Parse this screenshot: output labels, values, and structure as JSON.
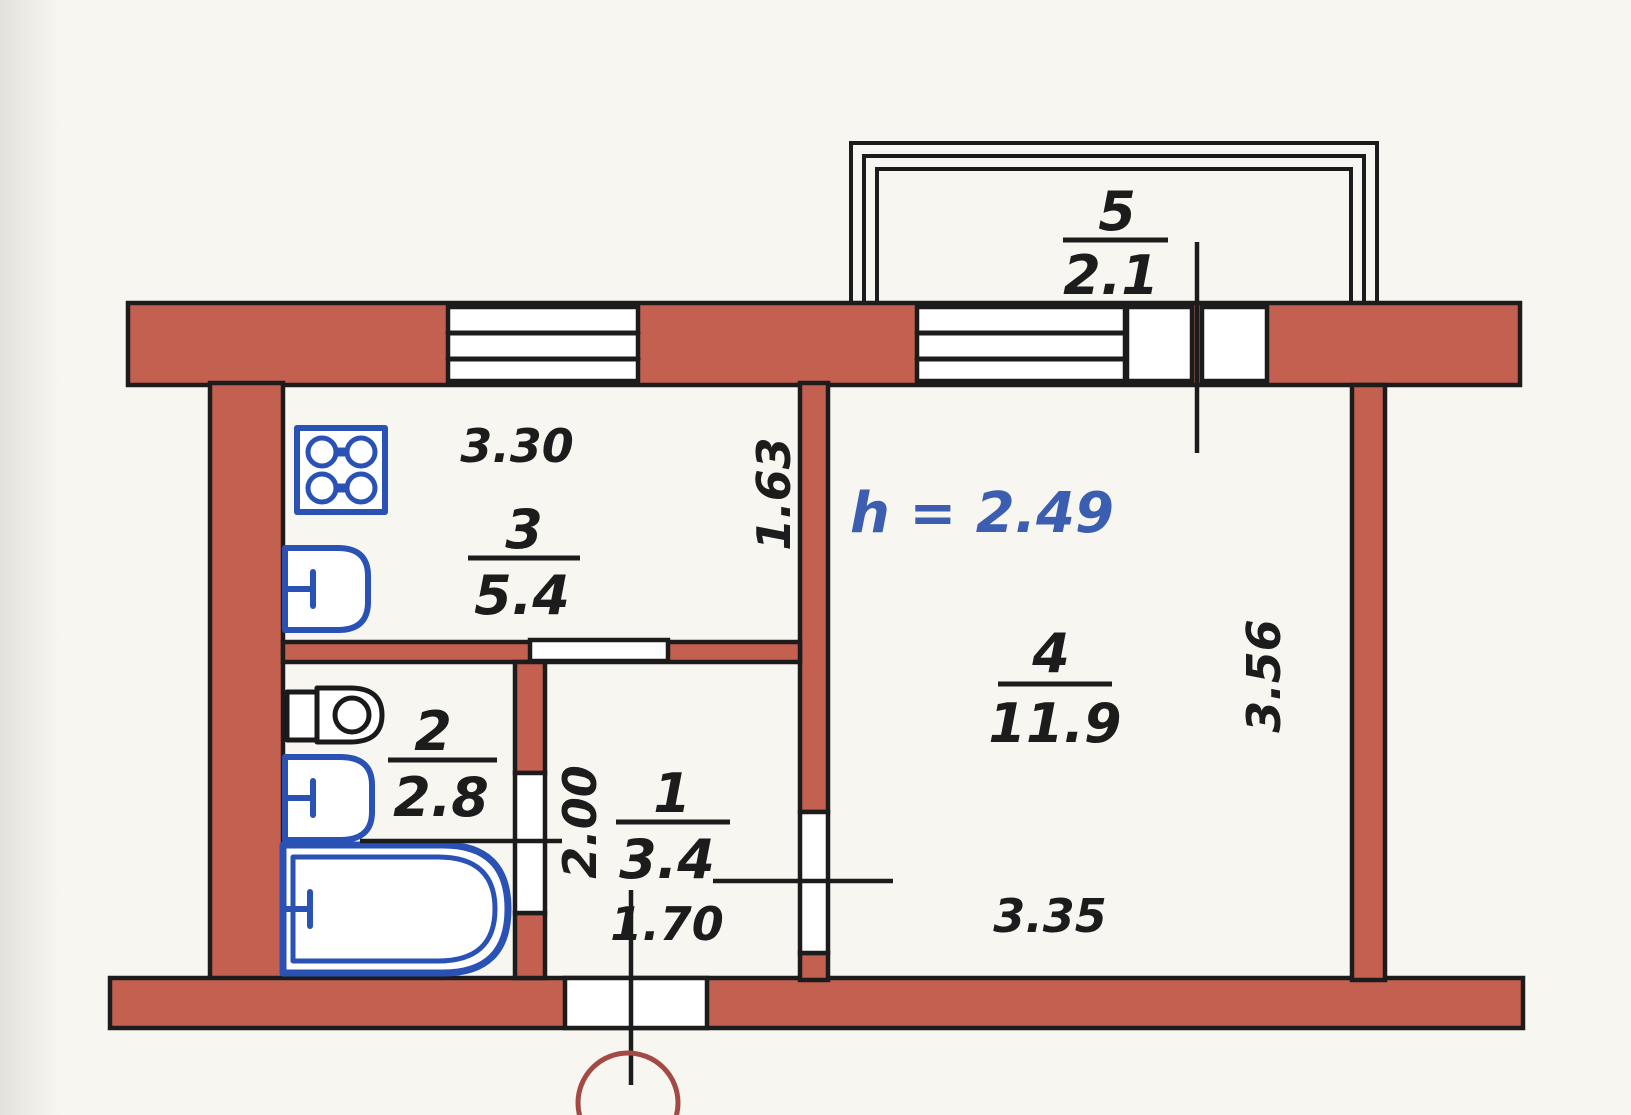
{
  "plan": {
    "type": "apartment-floor-plan",
    "rooms": [
      {
        "number": "1",
        "area": "3.4",
        "name": "hallway"
      },
      {
        "number": "2",
        "area": "2.8",
        "name": "bathroom"
      },
      {
        "number": "3",
        "area": "5.4",
        "name": "kitchen"
      },
      {
        "number": "4",
        "area": "11.9",
        "name": "living-room"
      },
      {
        "number": "5",
        "area": "2.1",
        "name": "balcony"
      }
    ],
    "ceiling_height": "h = 2.49",
    "dimensions": {
      "kitchen_width": "3.30",
      "kitchen_depth": "1.63",
      "bath_depth": "2.00",
      "hall_width": "1.70",
      "room_width": "3.35",
      "room_depth": "3.56"
    },
    "colors": {
      "wall_fill": "#c4604f",
      "outline": "#1c1c1c",
      "fixture_blue": "#2a52b5",
      "height_note_blue": "#3c5eb0",
      "entry_mark_red": "#a34a45",
      "paper": "#f8f6f0"
    }
  }
}
